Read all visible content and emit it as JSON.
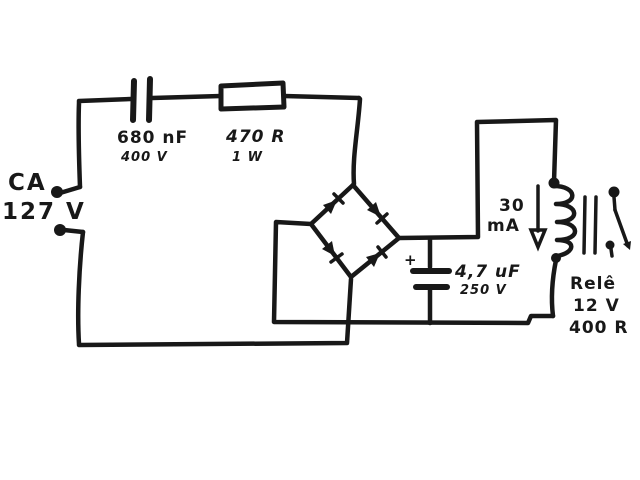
{
  "colors": {
    "ink": "#181818",
    "paper": "#ffffff"
  },
  "schematic": {
    "ac_source": {
      "label": "CA",
      "voltage": "127 V"
    },
    "series_capacitor": {
      "value": "680 nF",
      "rating": "400 V"
    },
    "series_resistor": {
      "value": "470 R",
      "rating": "1 W"
    },
    "bridge_rectifier": {
      "diode_count": 4
    },
    "filter_capacitor": {
      "polarity": "+",
      "value": "4,7 uF",
      "rating": "250 V"
    },
    "coil_current": {
      "value": "30",
      "unit": "mA"
    },
    "relay": {
      "name": "Relê",
      "voltage": "12 V",
      "coil_resistance": "400 R"
    }
  }
}
